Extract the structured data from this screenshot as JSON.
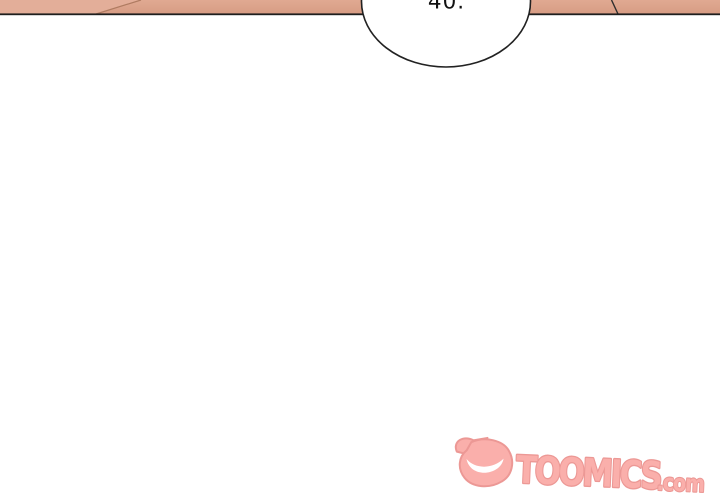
{
  "page": {
    "width": 720,
    "height": 500,
    "background_color": "#FFFFFF"
  },
  "comic_panel": {
    "skin_color": "#DCA28B",
    "skin_highlight_color": "#E3AE99",
    "skin_contour_line_color": "#AF7B61",
    "body_contour_line_color": "#2E2E2E",
    "panel_border_color": "#1E1E1E"
  },
  "speech_bubble": {
    "text": "40.",
    "fill_color": "#FFFFFF",
    "stroke_color": "#222222",
    "text_color": "#111111"
  },
  "watermark": {
    "brand": "TOOMICS",
    "tld": ".com",
    "fill_color": "#FAA9A4",
    "outline_color": "#EB908D",
    "icon": "toomics-devil-icon"
  }
}
